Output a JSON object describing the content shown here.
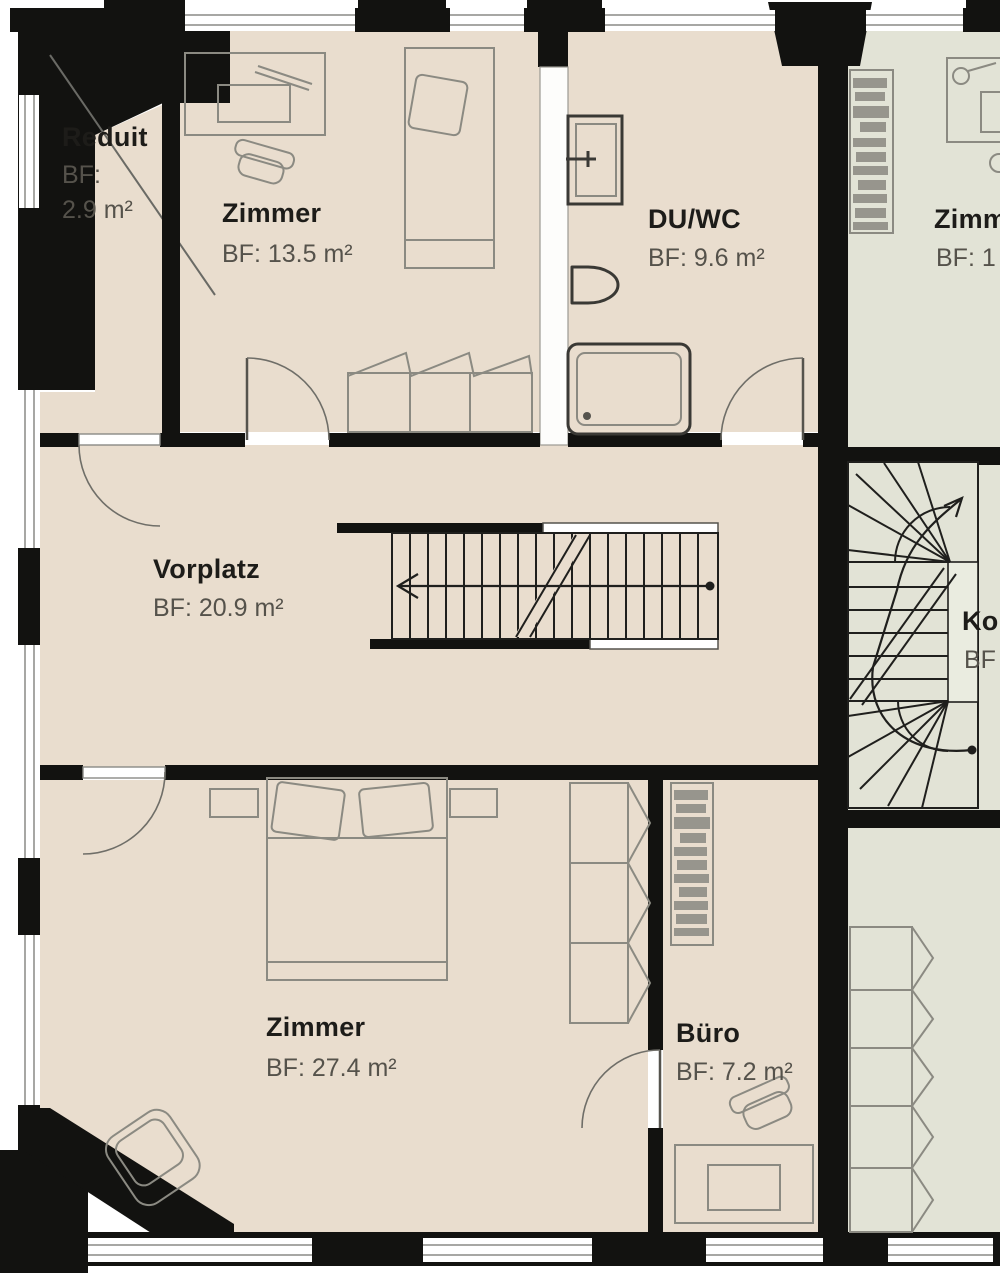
{
  "rooms": {
    "reduit": {
      "name": "Reduit",
      "area_label": "BF:",
      "area_value": "2.9 m²"
    },
    "zimmer_a": {
      "name": "Zimmer",
      "area": "BF: 13.5 m²"
    },
    "du_wc": {
      "name": "DU/WC",
      "area": "BF: 9.6 m²"
    },
    "vorplatz": {
      "name": "Vorplatz",
      "area": "BF: 20.9 m²"
    },
    "zimmer_b": {
      "name": "Zimmer",
      "area": "BF: 27.4 m²"
    },
    "buero": {
      "name": "Büro",
      "area": "BF: 7.2 m²"
    },
    "zimmer_neighbor": {
      "name": "Zimm",
      "area": "BF: 1"
    },
    "korridor_neighbor": {
      "name": "Ko",
      "area": "BF"
    }
  },
  "colors": {
    "floor_main": "#e9ddce",
    "floor_neighbor": "#e2e3d6",
    "wall": "#121210",
    "furniture_stroke": "#8b8a82",
    "room_label": "#1d1c19",
    "area_label": "#55524b"
  }
}
